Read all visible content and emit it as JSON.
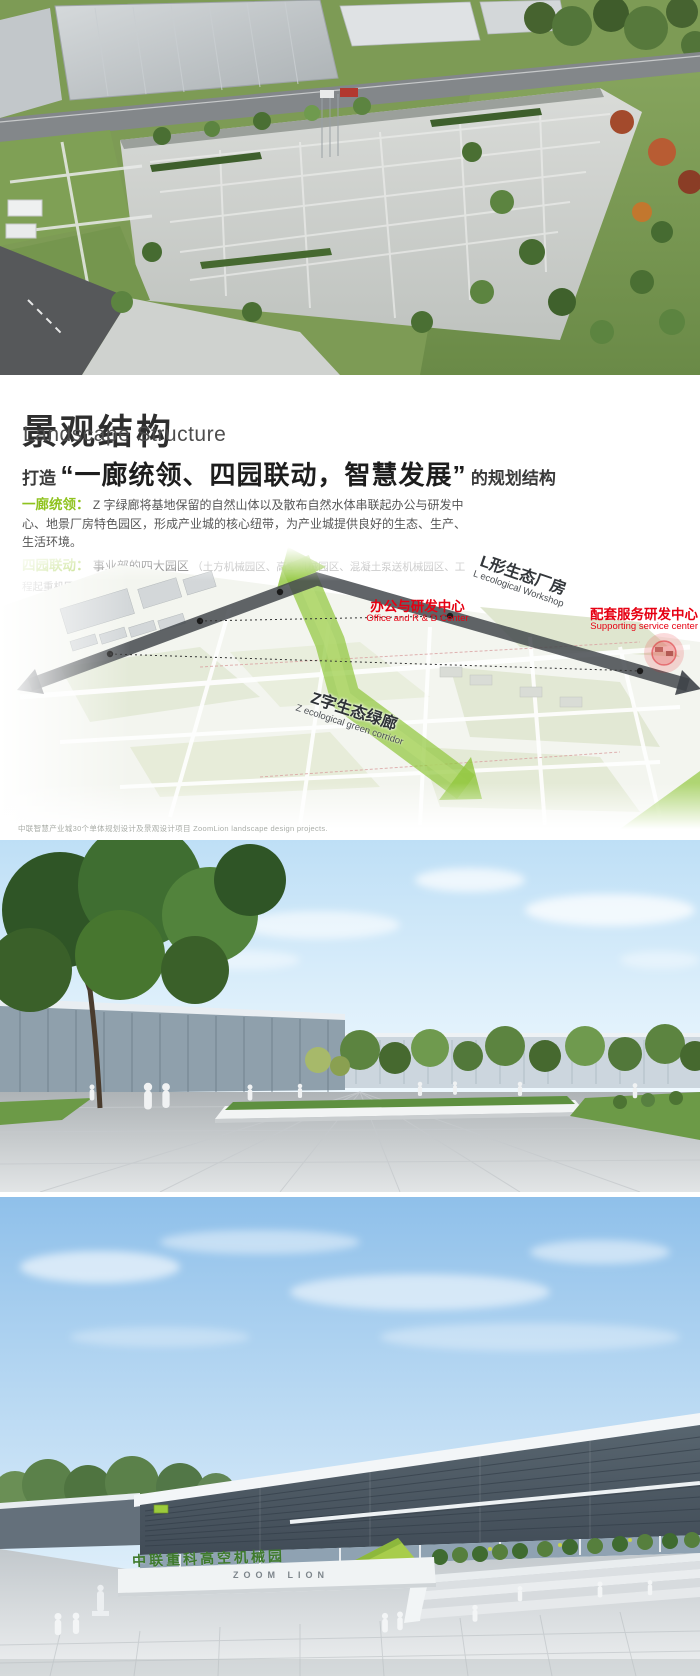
{
  "header": {
    "title_zh": "景观结构",
    "title_en": "Landscape Structure",
    "slogan_prefix": "打造",
    "slogan_quote": "“一廊统领、四园联动，智慧发展”",
    "slogan_suffix": "的规划结构"
  },
  "paragraphs": {
    "p1_label": "一廊统领：",
    "p1_text": "Z 字绿廊将基地保留的自然山体以及散布自然水体串联起办公与研发中心、地景厂房特色园区，形成产业城的核心纽带，为产业城提供良好的生态、生产、生活环境。",
    "p2_label": "四园联动：",
    "p2_lead": "事业部的四大园区",
    "p2_note": "（土方机械园区、高空机械园区、混凝土泵送机械园区、工程起重机园区）",
    "p2_tail": "由北向南排布，衔接联动。"
  },
  "diagram": {
    "office_zh": "办公与研发中心",
    "office_en": "Office and R & D Center",
    "workshop_zh": "L形生态厂房",
    "workshop_en": "L ecological Workshop",
    "support_zh": "配套服务研发中心",
    "support_en": "Supporting service center",
    "corridor_zh": "Z字生态绿廊",
    "corridor_en": "Z ecological green corridor",
    "colors": {
      "corridor_green": "#8dc63f",
      "ring_road_dark": "#4b5156",
      "highlight_red": "#e60012",
      "label_green": "#8fc31f"
    }
  },
  "caption": "中联智慧产业城30个单体规划设计及景观设计项目 ZoomLion landscape design projects.",
  "entrance_photo": {
    "hedge_text": "中联重科高空机械园",
    "wall_text": "ZOOM LION"
  }
}
